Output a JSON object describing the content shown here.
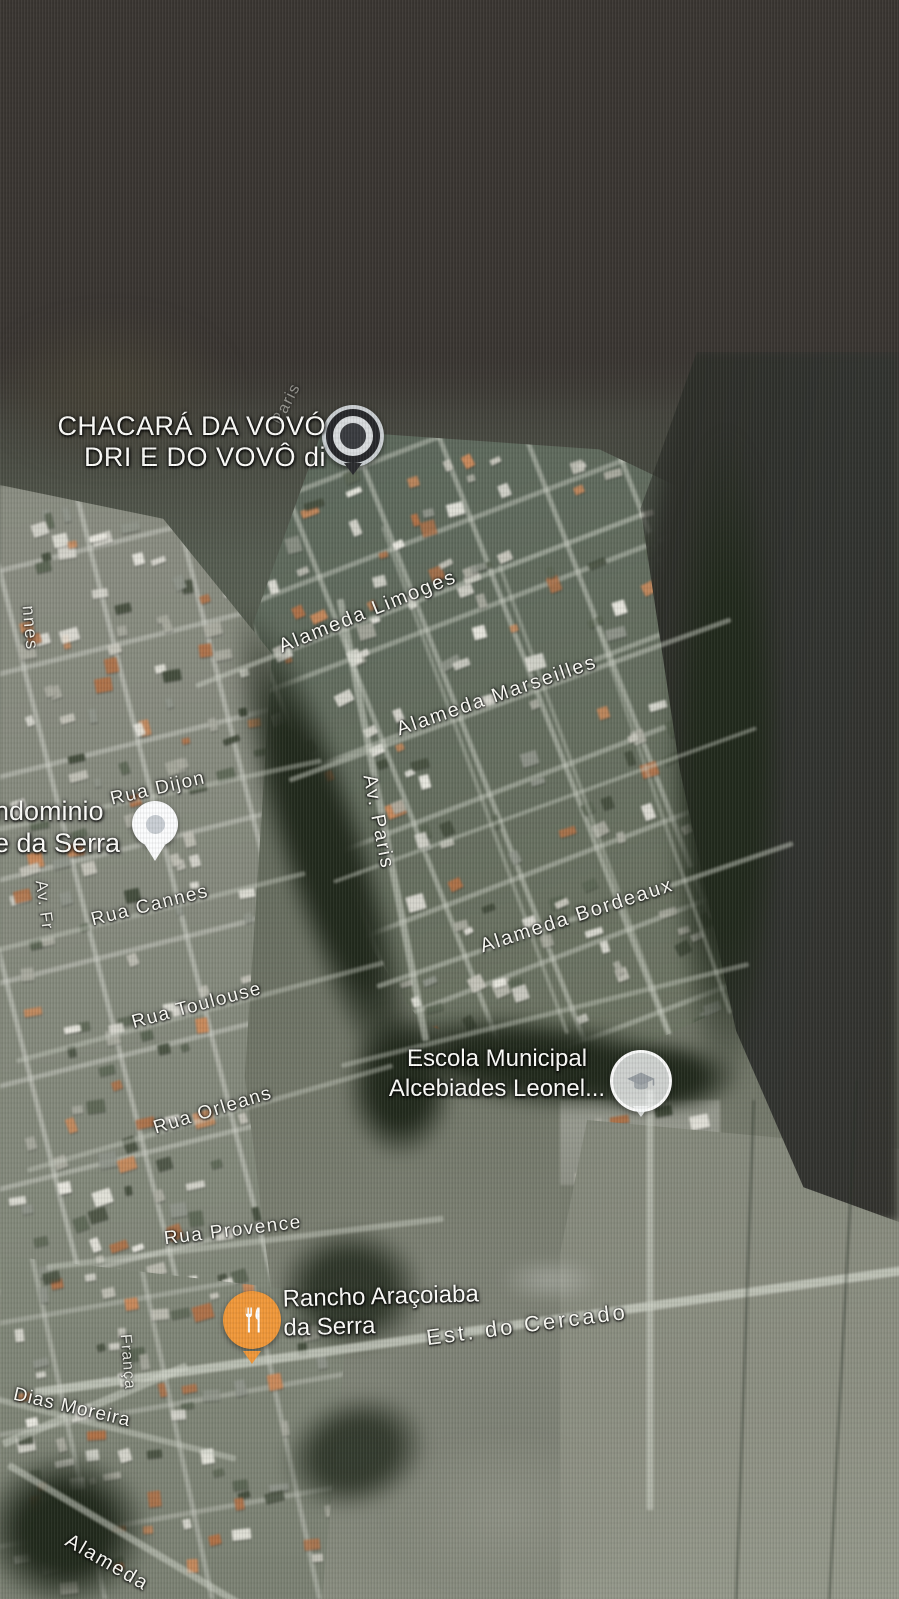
{
  "map": {
    "pois": [
      {
        "name": "chacara-da-vovo",
        "lines": [
          "CHACARÁ DA VOVÓ",
          "DRI E DO VOVÔ di"
        ],
        "marker": "generic-poi-pin"
      },
      {
        "name": "condominio-da-serra",
        "lines": [
          "ndominio",
          "e da Serra"
        ],
        "marker": "white-location-pin"
      },
      {
        "name": "escola-municipal",
        "lines": [
          "Escola Municipal",
          "Alcebiades Leonel..."
        ],
        "marker": "school-icon"
      },
      {
        "name": "rancho-aracoiaba",
        "lines": [
          "Rancho Araçoiaba",
          "da Serra"
        ],
        "marker": "restaurant-icon"
      }
    ],
    "streets": [
      {
        "name": "alameda-limoges",
        "text": "Alameda Limoges"
      },
      {
        "name": "alameda-marseilles",
        "text": "Alameda Marseilles"
      },
      {
        "name": "av-paris",
        "text": "Av. Paris"
      },
      {
        "name": "rua-dijon",
        "text": "Rua Dijon"
      },
      {
        "name": "rua-cannes",
        "text": "Rua Cannes"
      },
      {
        "name": "alameda-bordeaux",
        "text": "Alameda Bordeaux"
      },
      {
        "name": "rua-toulouse",
        "text": "Rua Toulouse"
      },
      {
        "name": "rua-orleans",
        "text": "Rua Orleans"
      },
      {
        "name": "rua-provence",
        "text": "Rua Provence"
      },
      {
        "name": "est-do-cercado",
        "text": "Est. do Cercado"
      },
      {
        "name": "dias-moreira",
        "text": "Dias Moreira"
      },
      {
        "name": "franca",
        "text": "França"
      },
      {
        "name": "alameda",
        "text": "Alameda"
      },
      {
        "name": "fragment-nnes",
        "text": "nnes"
      },
      {
        "name": "fragment-av-fr",
        "text": "Av. Fr"
      },
      {
        "name": "fragment-paris",
        "text": "Paris"
      }
    ],
    "palette": {
      "label_text": "#fdfdfa",
      "restaurant_pin": "#f0983a",
      "poi_pin_dark": "#27282b",
      "poi_pin_ring": "#d9dcde",
      "white_pin": "#fbfcfd",
      "school_badge": "#f4f6f7",
      "road_light": "#cdd1c6",
      "vegetation_dark": "#242b1f",
      "field_gray": "#8a8e81",
      "buildings": [
        "#dad9d1",
        "#c6c5bb",
        "#abaca1",
        "#c9895b",
        "#b07147",
        "#90958b",
        "#5c6655",
        "#454e3e",
        "#e9e8e0"
      ]
    }
  }
}
